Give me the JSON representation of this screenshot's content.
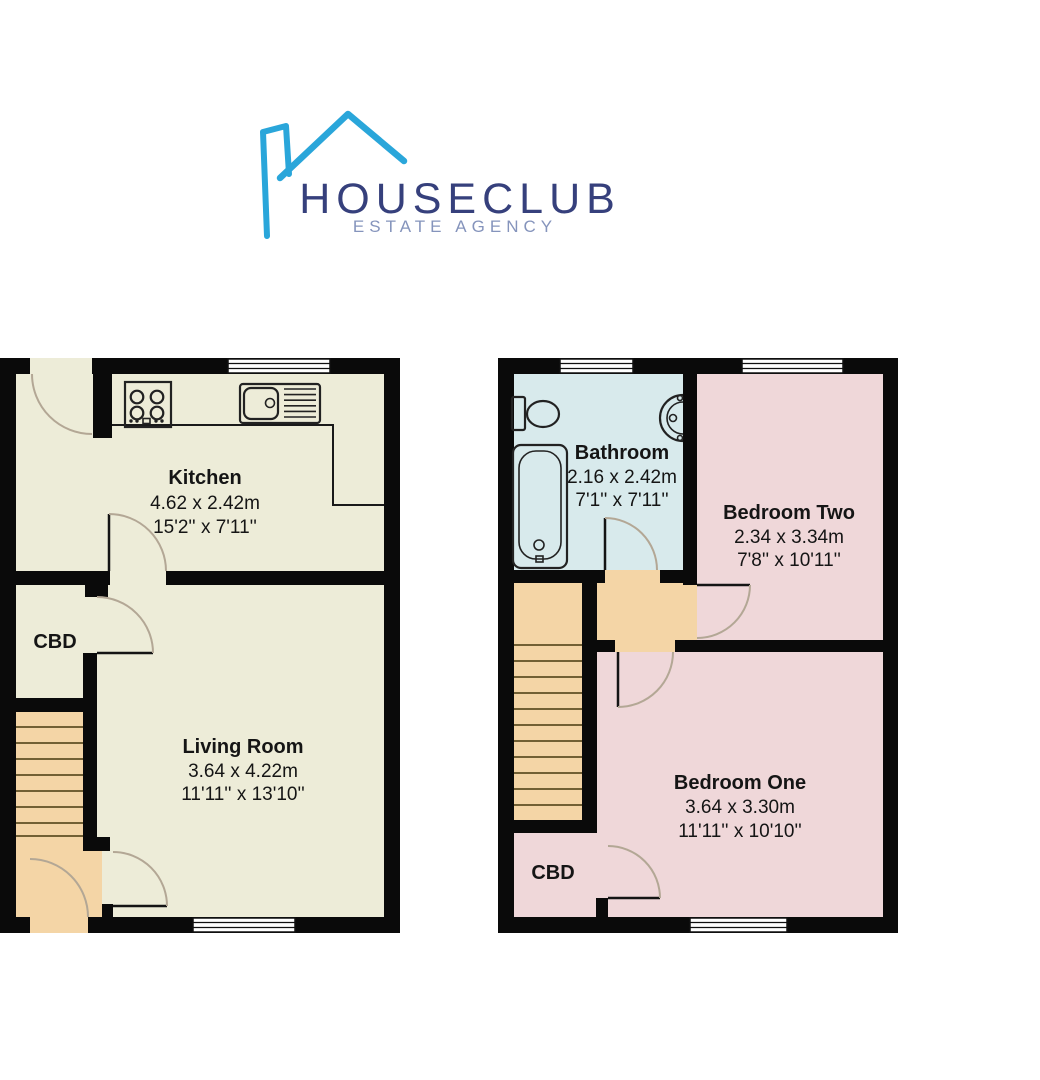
{
  "logo": {
    "brand": "HOUSECLUB",
    "tagline": "ESTATE AGENCY"
  },
  "ground_floor": {
    "kitchen": {
      "name": "Kitchen",
      "metric": "4.62 x 2.42m",
      "imperial": "15'2'' x 7'11''"
    },
    "living_room": {
      "name": "Living Room",
      "metric": "3.64 x 4.22m",
      "imperial": "11'11'' x 13'10''"
    },
    "cupboard": {
      "label": "CBD"
    }
  },
  "first_floor": {
    "bathroom": {
      "name": "Bathroom",
      "metric": "2.16 x 2.42m",
      "imperial": "7'1'' x 7'11''"
    },
    "bedroom_two": {
      "name": "Bedroom Two",
      "metric": "2.34 x 3.34m",
      "imperial": "7'8'' x 10'11''"
    },
    "bedroom_one": {
      "name": "Bedroom One",
      "metric": "3.64 x 3.30m",
      "imperial": "11'11'' x 10'10''"
    },
    "cupboard": {
      "label": "CBD"
    }
  },
  "colors": {
    "wall": "#0a0a0a",
    "room_cream": "#edecd8",
    "room_pink": "#efd7d9",
    "room_blue": "#d8eaec",
    "hall_tan": "#f4d5a6",
    "window_white": "#ffffff",
    "door_arc": "#b3a795",
    "logo_sky_blue": "#2aa6da",
    "logo_navy": "#36407c",
    "logo_slate": "#8594bc"
  }
}
